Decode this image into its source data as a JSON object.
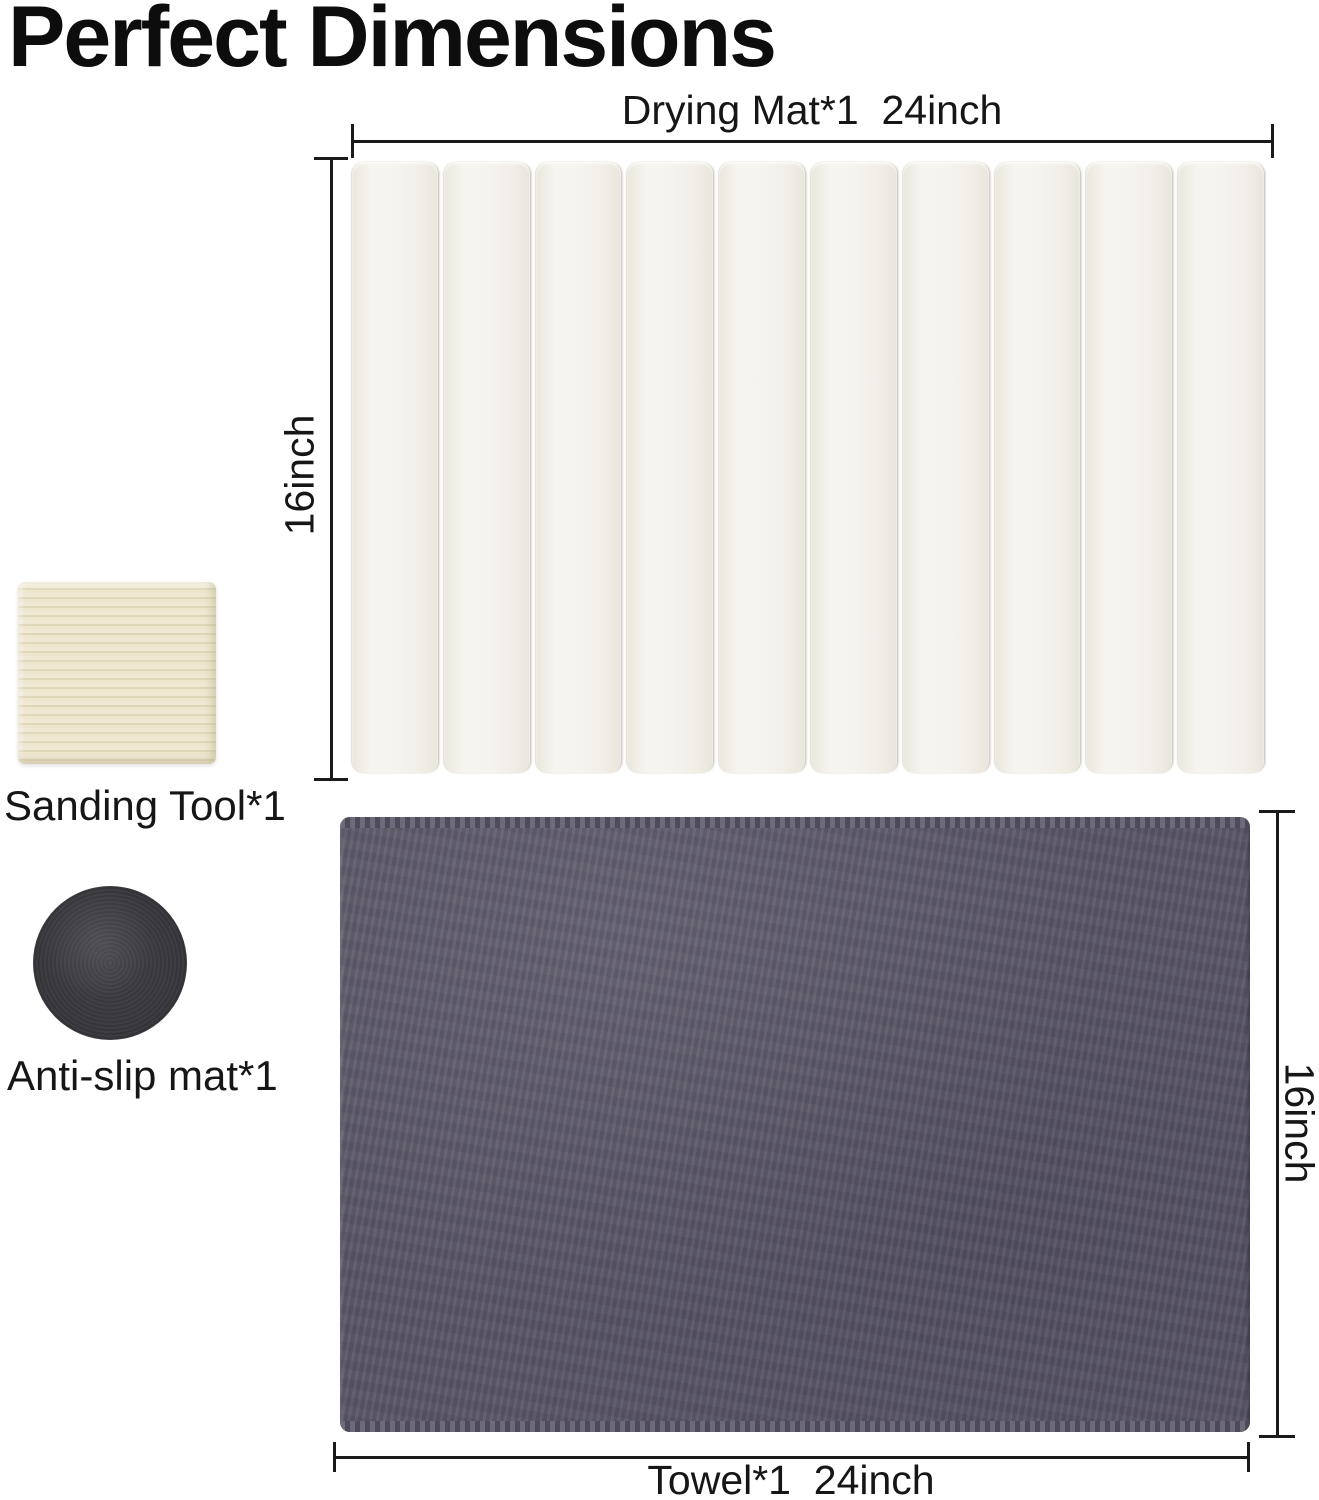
{
  "title": "Perfect Dimensions",
  "drying_mat": {
    "dim_width_label": "Drying Mat*1  24inch",
    "dim_height_label": "16inch",
    "slat_count": 10,
    "slat_color": "#f4f2ec"
  },
  "towel": {
    "dim_width_label": "Towel*1  24inch",
    "dim_height_label": "16inch",
    "color": "#575364",
    "stitch_color": "#6f6c7b"
  },
  "sanding_tool": {
    "label": "Sanding Tool*1",
    "color": "#e8e2c7"
  },
  "anti_slip_mat": {
    "label": "Anti-slip mat*1",
    "color": "#38373c"
  },
  "colors": {
    "background": "#ffffff",
    "text": "#111111",
    "dimension_line": "#1a1a1a"
  }
}
